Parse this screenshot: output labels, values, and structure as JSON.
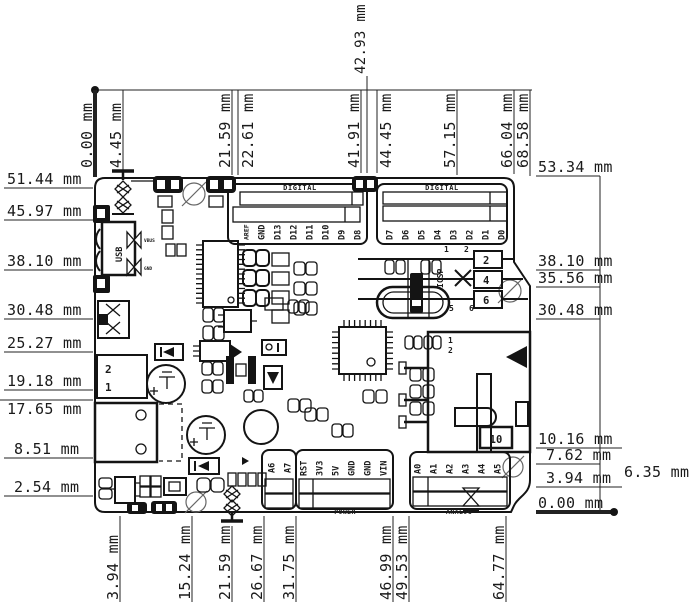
{
  "drawing": {
    "unit": "mm",
    "dims": {
      "top": [
        "0.00 mm",
        "4.45 mm",
        "21.59 mm",
        "22.61 mm",
        "42.93 mm",
        "41.91 mm",
        "44.45 mm",
        "57.15 mm",
        "66.04 mm",
        "68.58 mm"
      ],
      "left": [
        "51.44 mm",
        "45.97 mm",
        "38.10 mm",
        "30.48 mm",
        "25.27 mm",
        "19.18 mm",
        "17.65 mm",
        "8.51 mm",
        "2.54 mm"
      ],
      "right": [
        "53.34 mm",
        "38.10 mm",
        "35.56 mm",
        "30.48 mm",
        "10.16 mm",
        "7.62 mm",
        "6.35 mm",
        "3.94 mm",
        "0.00 mm"
      ],
      "bottom": [
        "3.94 mm",
        "15.24 mm",
        "21.59 mm",
        "26.67 mm",
        "31.75 mm",
        "46.99 mm",
        "49.53 mm",
        "64.77 mm"
      ]
    }
  },
  "board": {
    "headers": {
      "digital_left": {
        "label": "DIGITAL",
        "pins": [
          "AREF",
          "GND",
          "D13",
          "D12",
          "D11",
          "D10",
          "D9",
          "D8"
        ]
      },
      "digital_right": {
        "label": "DIGITAL",
        "pins": [
          "D7",
          "D6",
          "D5",
          "D4",
          "D3",
          "D2",
          "D1",
          "D0"
        ]
      },
      "power": {
        "label": "POWER",
        "pins": [
          "RST",
          "3V3",
          "5V",
          "GND",
          "GND",
          "VIN"
        ]
      },
      "aux": {
        "pins": [
          "A6",
          "A7"
        ]
      },
      "analog": {
        "label": "ANALOG",
        "pins": [
          "A0",
          "A1",
          "A2",
          "A3",
          "A4",
          "A5"
        ]
      }
    },
    "icsp": {
      "label": "ICSP",
      "top_pins": [
        "1",
        "2"
      ],
      "bottom_pins": [
        "5",
        "6"
      ],
      "boxed_pins": [
        "2",
        "4",
        "6"
      ]
    },
    "usb": {
      "label": "USB",
      "pad_labels": [
        "VBUS",
        "GND"
      ]
    },
    "power_jack": {
      "pin_top": "2",
      "pin_bottom": "1"
    },
    "connector": {
      "pin_top": "1",
      "pin_bottom": "2",
      "value": "10"
    }
  }
}
